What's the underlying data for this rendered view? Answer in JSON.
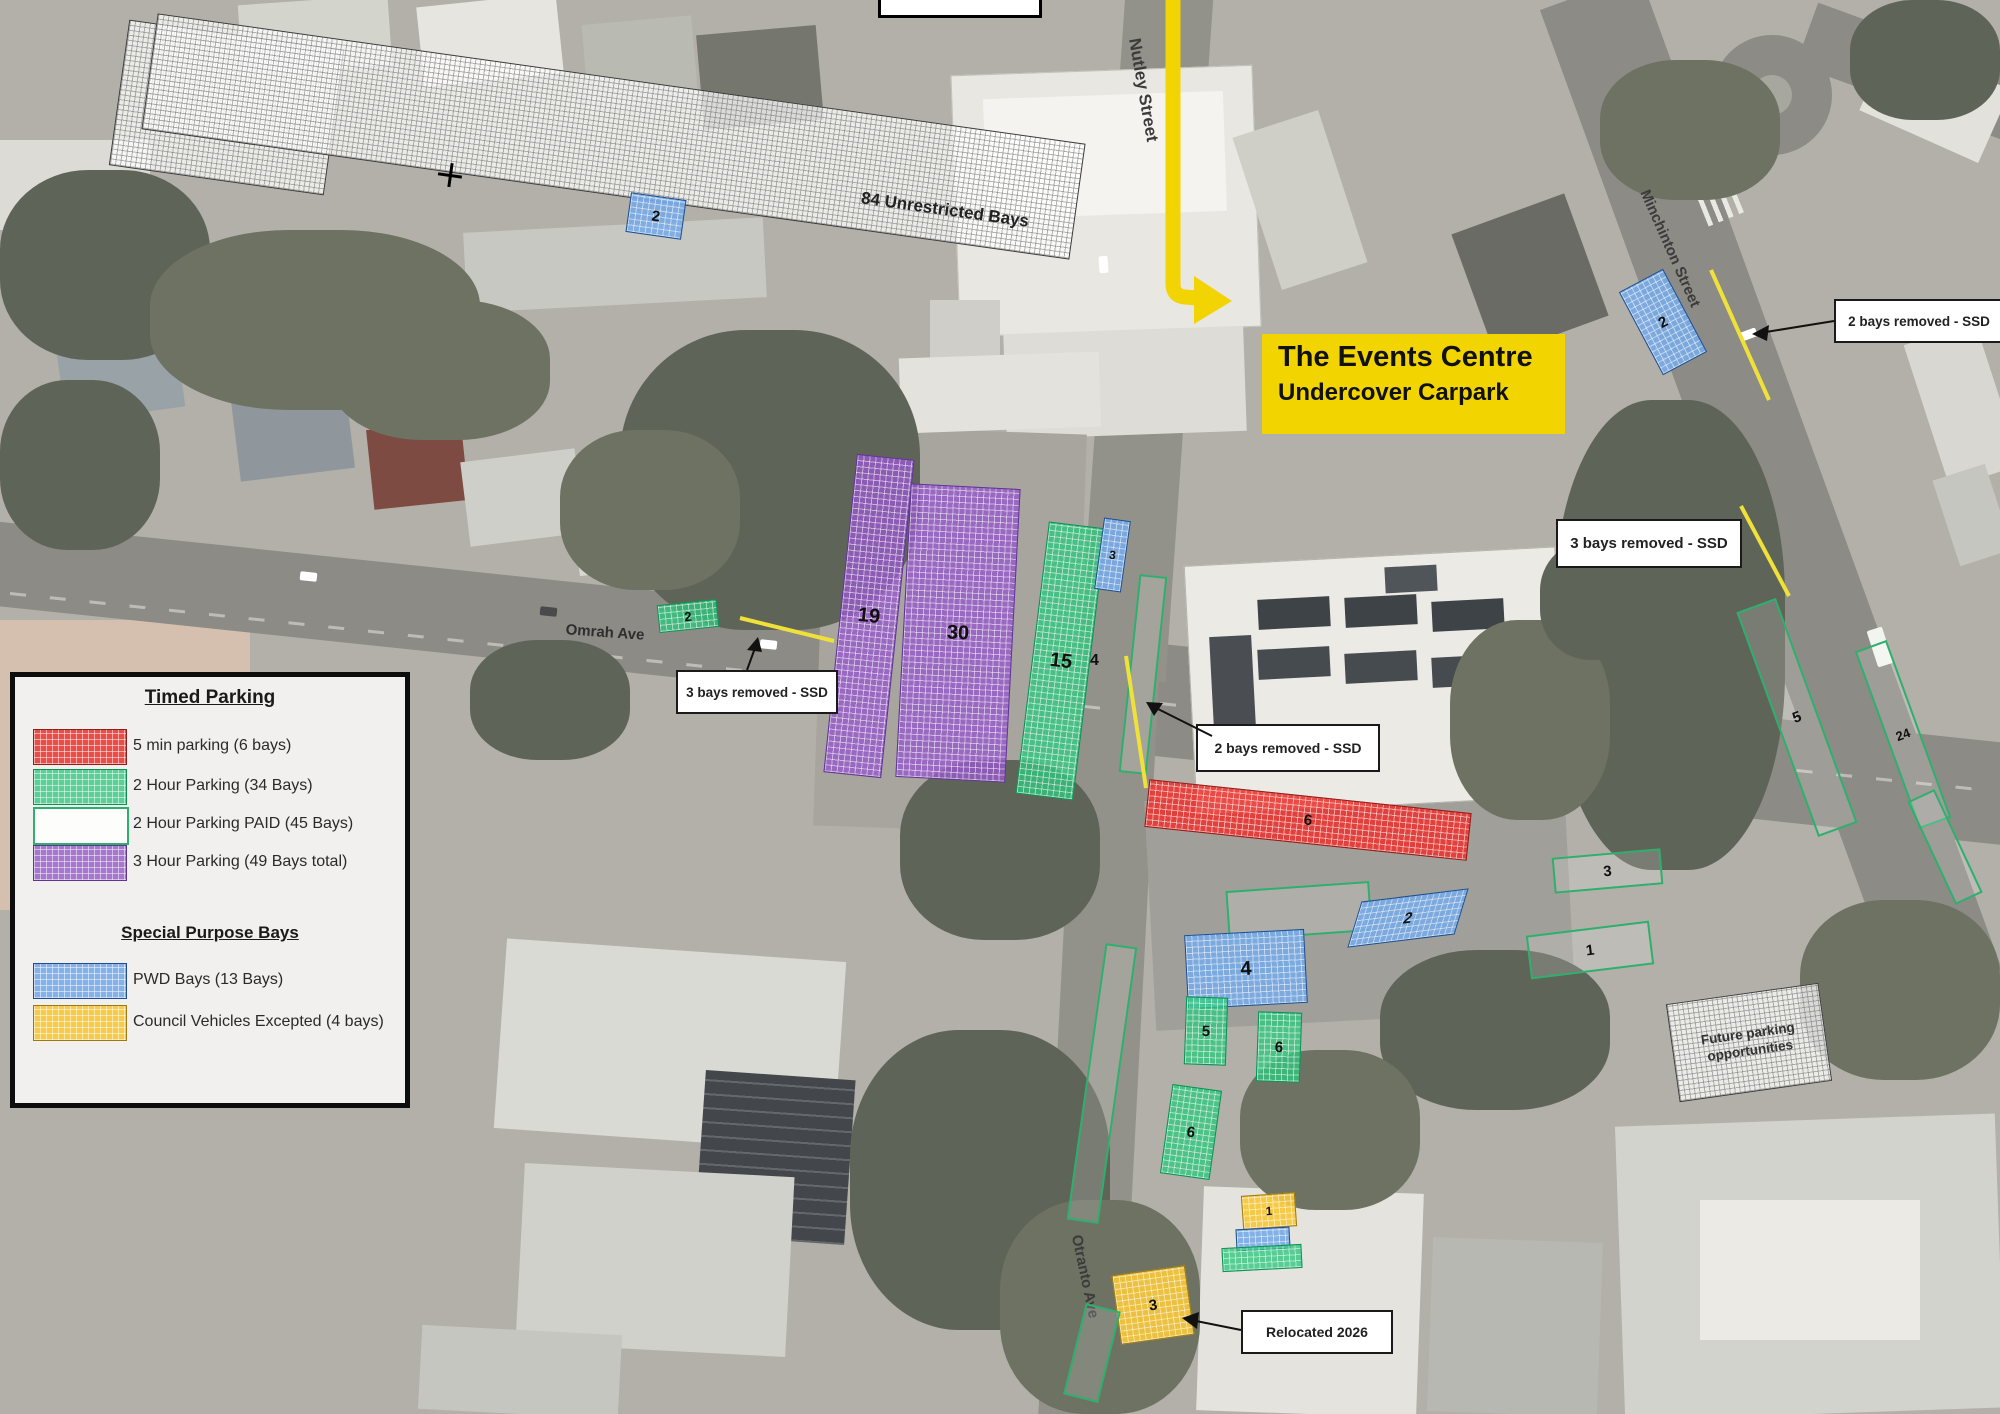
{
  "legend": {
    "timed_title": "Timed Parking",
    "timed_items": [
      {
        "label": "5 min parking (6 bays)",
        "color": "#e8413c",
        "style": "hatched"
      },
      {
        "label": "2 Hour Parking  (34 Bays)",
        "color": "#2fc67e",
        "style": "hatched"
      },
      {
        "label": "2 Hour Parking  PAID (45 Bays)",
        "color": "#ffffff",
        "style": "outlined-green"
      },
      {
        "label": "3 Hour Parking  (49 Bays total)",
        "color": "#965ac8",
        "style": "hatched"
      }
    ],
    "special_title": "Special Purpose Bays",
    "special_items": [
      {
        "label": "PWD Bays (13 Bays)",
        "color": "#78aae6",
        "style": "hatched"
      },
      {
        "label": "Council Vehicles Excepted (4 bays)",
        "color": "#f7c83c",
        "style": "hatched"
      }
    ]
  },
  "map": {
    "streets": {
      "nutley": "Nutley Street",
      "minchinton": "Minchinton Street",
      "omrah": "Omrah Ave",
      "otranto": "Otranto Ave"
    },
    "events_label": {
      "line1": "The Events Centre",
      "line2": "Undercover Carpark"
    },
    "unrestricted_label": "84 Unrestricted Bays",
    "future_parking_label": "Future parking opportunities",
    "callouts": {
      "minchinton_top": "2 bays removed - SSD",
      "minchinton_mid": "3 bays removed - SSD",
      "nutley": "2 bays removed - SSD",
      "omrah": "3 bays removed - SSD",
      "relocated": "Relocated 2026"
    },
    "zones": {
      "purple_a": "19",
      "purple_b": "30",
      "green_a": "15",
      "pwd_strip": "3",
      "paid_nutley": "4",
      "red_bays": "6",
      "paid_east": "3",
      "pwd_cars": "2",
      "paid_far": "1",
      "pwd_main": "4",
      "green_b": "5",
      "green_c": "6",
      "green_d": "6",
      "council_a": "1",
      "council_b": "3",
      "green_omrah": "2",
      "paid_minch_a": "5",
      "paid_minch_b": "24",
      "pwd_minch": "2",
      "pwd_unrestricted": "2"
    },
    "colors": {
      "highlight": "#f2d500",
      "paid_outline": "#2eaf6e",
      "arrow_yellow": "#f3d403"
    }
  }
}
